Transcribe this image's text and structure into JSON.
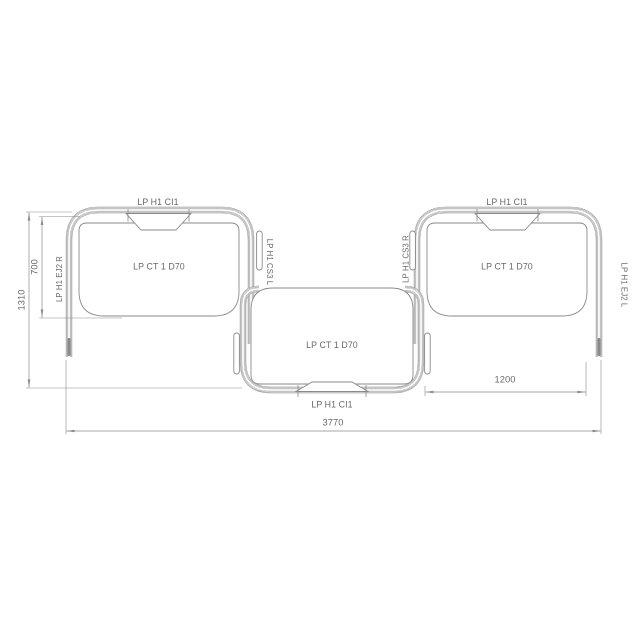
{
  "drawing": {
    "left_unit": {
      "top_label": "LP H1 CI1",
      "panel_label": "LP CT 1 D70",
      "outer_label": "LP H1 EJ2 R",
      "inner_label": "LP H1 CS3 L"
    },
    "middle_unit": {
      "panel_label": "LP CT 1 D70",
      "bottom_label": "LP H1 CI1"
    },
    "right_unit": {
      "top_label": "LP H1 CI1",
      "panel_label": "LP CT 1 D70",
      "inner_label": "LP H1 CS3 R",
      "outer_label": "LP H1 EJ2 L"
    },
    "dimensions": {
      "overall_width": "3770",
      "total_height": "1310",
      "backrest_height": "700",
      "right_opening_width": "1200"
    },
    "colors": {
      "line": "#8a8a8a",
      "text": "#686868",
      "background": "#ffffff"
    }
  }
}
